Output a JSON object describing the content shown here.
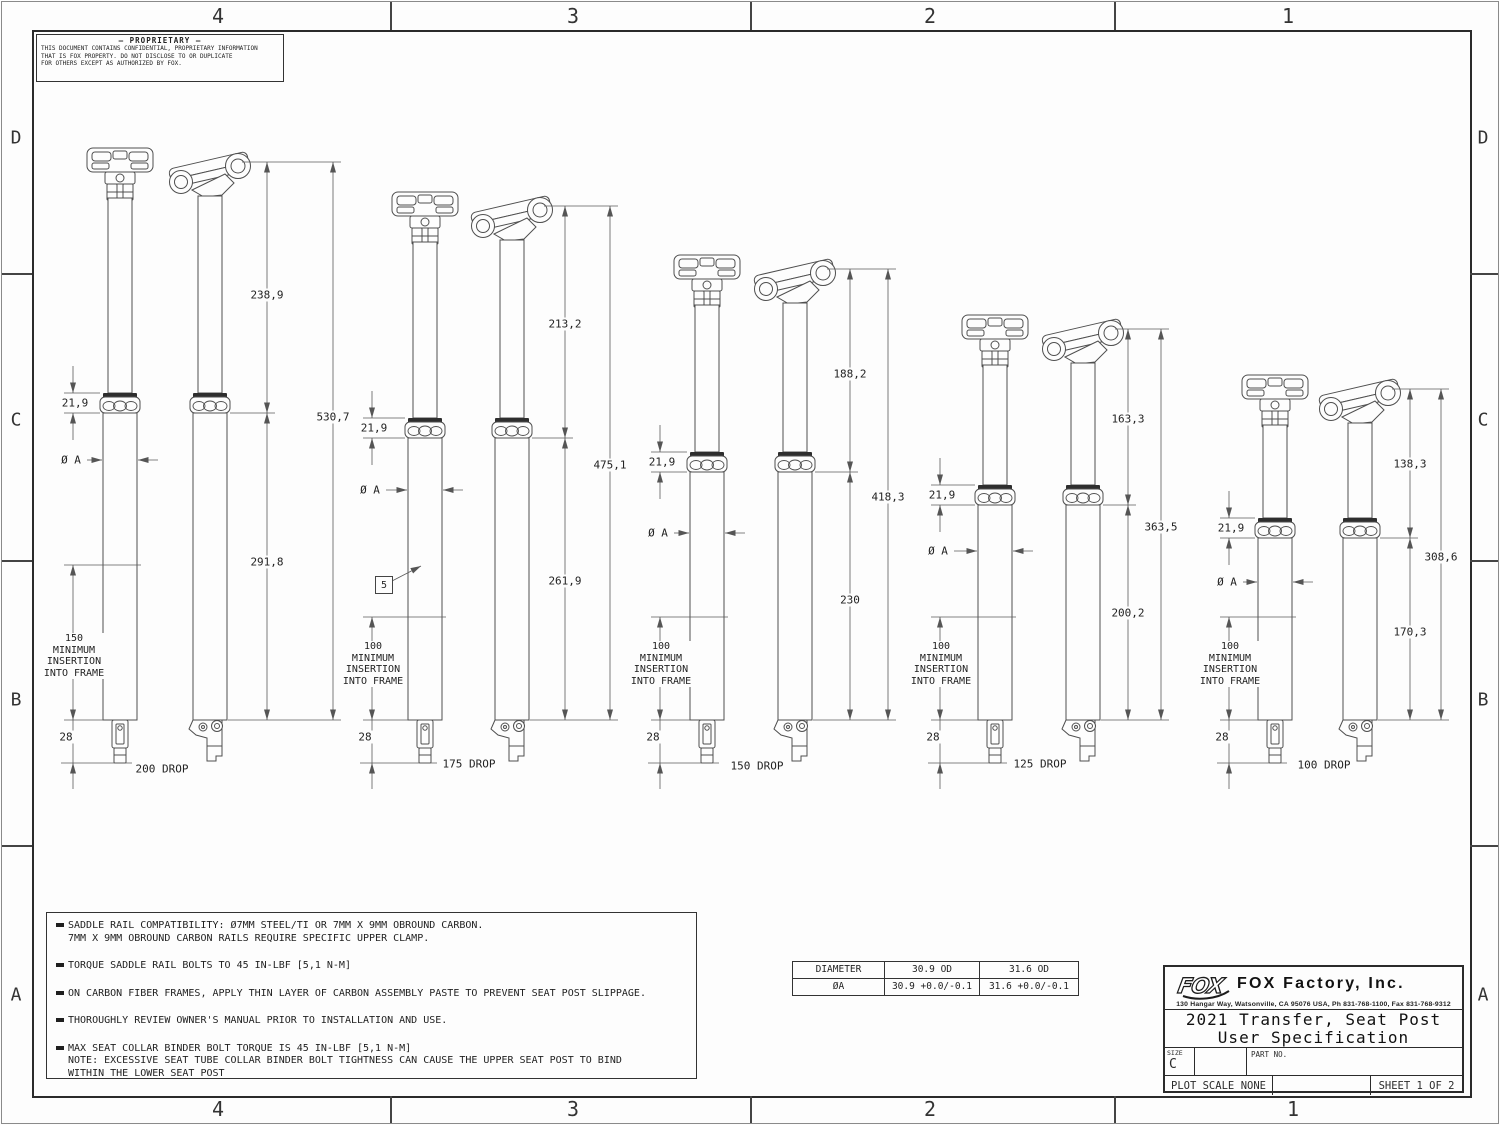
{
  "sheet": {
    "zones_top": [
      "4",
      "3",
      "2",
      "1"
    ],
    "zones_bottom": [
      "4",
      "3",
      "2",
      "1"
    ],
    "zones_left": [
      "D",
      "C",
      "B",
      "A"
    ],
    "zones_right": [
      "D",
      "C",
      "B",
      "A"
    ]
  },
  "proprietary": {
    "title": "—  PROPRIETARY  —",
    "lines": [
      "THIS DOCUMENT CONTAINS CONFIDENTIAL, PROPRIETARY INFORMATION",
      "THAT IS FOX PROPERTY.  DO NOT DISCLOSE TO OR DUPLICATE",
      "FOR OTHERS EXCEPT AS AUTHORIZED BY FOX."
    ]
  },
  "posts": [
    {
      "upper": "238,9",
      "total": "530,7",
      "lower": "291,8",
      "collar": "21,9",
      "diameter": "Ø A",
      "insertion_lines": [
        "150",
        "MINIMUM",
        "INSERTION",
        "INTO FRAME"
      ],
      "tip": "28",
      "drop": "200 DROP"
    },
    {
      "upper": "213,2",
      "total": "475,1",
      "lower": "261,9",
      "collar": "21,9",
      "diameter": "Ø A",
      "insertion_lines": [
        "100",
        "MINIMUM",
        "INSERTION",
        "INTO FRAME"
      ],
      "tip": "28",
      "drop": "175 DROP",
      "flag": "5"
    },
    {
      "upper": "188,2",
      "total": "418,3",
      "lower": "230",
      "collar": "21,9",
      "diameter": "Ø A",
      "insertion_lines": [
        "100",
        "MINIMUM",
        "INSERTION",
        "INTO FRAME"
      ],
      "tip": "28",
      "drop": "150 DROP"
    },
    {
      "upper": "163,3",
      "total": "363,5",
      "lower": "200,2",
      "collar": "21,9",
      "diameter": "Ø A",
      "insertion_lines": [
        "100",
        "MINIMUM",
        "INSERTION",
        "INTO FRAME"
      ],
      "tip": "28",
      "drop": "125 DROP"
    },
    {
      "upper": "138,3",
      "total": "308,6",
      "lower": "170,3",
      "collar": "21,9",
      "diameter": "Ø A",
      "insertion_lines": [
        "100",
        "MINIMUM",
        "INSERTION",
        "INTO FRAME"
      ],
      "tip": "28",
      "drop": "100 DROP"
    }
  ],
  "notes": [
    {
      "lines": [
        "SADDLE RAIL COMPATIBILITY: Ø7MM STEEL/TI OR 7MM X 9MM OBROUND CARBON.",
        "7MM X 9MM OBROUND CARBON RAILS REQUIRE SPECIFIC UPPER CLAMP."
      ]
    },
    {
      "lines": [
        "TORQUE SADDLE RAIL BOLTS TO 45 IN-LBF [5,1 N-M]"
      ]
    },
    {
      "lines": [
        "ON CARBON FIBER FRAMES, APPLY THIN LAYER OF CARBON ASSEMBLY PASTE TO PREVENT SEAT POST SLIPPAGE."
      ]
    },
    {
      "lines": [
        "THOROUGHLY REVIEW OWNER'S MANUAL PRIOR TO INSTALLATION AND USE."
      ]
    },
    {
      "lines": [
        "MAX SEAT COLLAR BINDER BOLT TORQUE IS 45 IN-LBF [5,1 N-M]",
        "NOTE: EXCESSIVE SEAT TUBE COLLAR BINDER BOLT TIGHTNESS CAN CAUSE THE UPPER SEAT POST TO BIND",
        "WITHIN THE LOWER SEAT POST"
      ]
    }
  ],
  "diameter_table": {
    "headers": [
      "DIAMETER",
      "30.9 OD",
      "31.6 OD"
    ],
    "row_label": "ØA",
    "row_values": [
      "30.9 +0.0/-0.1",
      "31.6 +0.0/-0.1"
    ]
  },
  "title_block": {
    "logo_text": "FOX",
    "company": "FOX Factory, Inc.",
    "address": "130 Hangar Way, Watsonville, CA 95076 USA, Ph 831-768-1100, Fax 831-768-9312",
    "title_line1": "2021 Transfer, Seat Post",
    "title_line2": "User Specification",
    "size_label": "SIZE",
    "size_value": "C",
    "part_no_label": "PART NO.",
    "plot_scale_label": "PLOT SCALE",
    "plot_scale_value": "NONE",
    "sheet_label": "SHEET 1 OF 2"
  }
}
